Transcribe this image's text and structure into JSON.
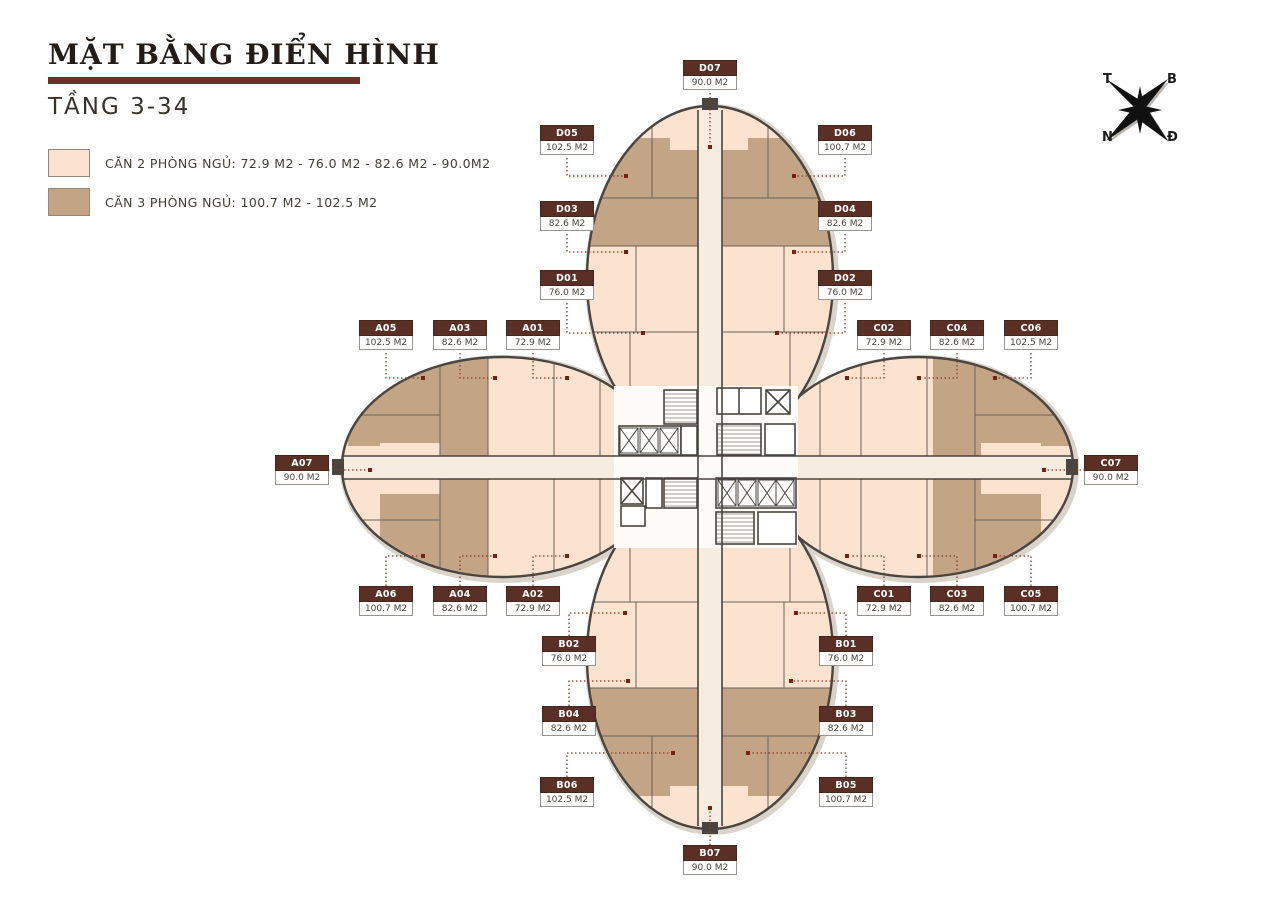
{
  "title": "MẶT BẰNG ĐIỂN HÌNH",
  "subtitle": "TẦNG 3-34",
  "legend": {
    "two_bedroom": {
      "label": "CĂN 2 PHÒNG NGỦ: 72.9 M2 - 76.0 M2 - 82.6 M2 - 90.0M2",
      "color": "#fbe3d0"
    },
    "three_bedroom": {
      "label": "CĂN 3 PHÒNG NGỦ: 100.7 M2 - 102.5 M2",
      "color": "#c3a586"
    }
  },
  "compass": {
    "top_left": "T",
    "top_right": "B",
    "bottom_left": "N",
    "bottom_right": "Đ"
  },
  "units": {
    "A01": {
      "id": "A01",
      "area": "72.9 M2"
    },
    "A02": {
      "id": "A02",
      "area": "72.9 M2"
    },
    "A03": {
      "id": "A03",
      "area": "82.6 M2"
    },
    "A04": {
      "id": "A04",
      "area": "82.6 M2"
    },
    "A05": {
      "id": "A05",
      "area": "102.5 M2"
    },
    "A06": {
      "id": "A06",
      "area": "100.7 M2"
    },
    "A07": {
      "id": "A07",
      "area": "90.0 M2"
    },
    "B01": {
      "id": "B01",
      "area": "76.0 M2"
    },
    "B02": {
      "id": "B02",
      "area": "76.0 M2"
    },
    "B03": {
      "id": "B03",
      "area": "82.6 M2"
    },
    "B04": {
      "id": "B04",
      "area": "82.6 M2"
    },
    "B05": {
      "id": "B05",
      "area": "100.7 M2"
    },
    "B06": {
      "id": "B06",
      "area": "102.5 M2"
    },
    "B07": {
      "id": "B07",
      "area": "90.0 M2"
    },
    "C01": {
      "id": "C01",
      "area": "72.9 M2"
    },
    "C02": {
      "id": "C02",
      "area": "72.9 M2"
    },
    "C03": {
      "id": "C03",
      "area": "82.6 M2"
    },
    "C04": {
      "id": "C04",
      "area": "82.6 M2"
    },
    "C05": {
      "id": "C05",
      "area": "100.7 M2"
    },
    "C06": {
      "id": "C06",
      "area": "102.5 M2"
    },
    "C07": {
      "id": "C07",
      "area": "90.0 M2"
    },
    "D01": {
      "id": "D01",
      "area": "76.0 M2"
    },
    "D02": {
      "id": "D02",
      "area": "76.0 M2"
    },
    "D03": {
      "id": "D03",
      "area": "82.6 M2"
    },
    "D04": {
      "id": "D04",
      "area": "82.6 M2"
    },
    "D05": {
      "id": "D05",
      "area": "102.5 M2"
    },
    "D06": {
      "id": "D06",
      "area": "100.7 M2"
    },
    "D07": {
      "id": "D07",
      "area": "90.0 M2"
    }
  },
  "colors": {
    "accent_bar": "#6b3226",
    "callout_header": "#5a3026",
    "leader_line": "#8a3a22",
    "unit_dot": "#7a1f14",
    "wall": "#4a4540",
    "two_bedroom_fill": "#fbe3d0",
    "three_bedroom_fill": "#c3a586"
  }
}
